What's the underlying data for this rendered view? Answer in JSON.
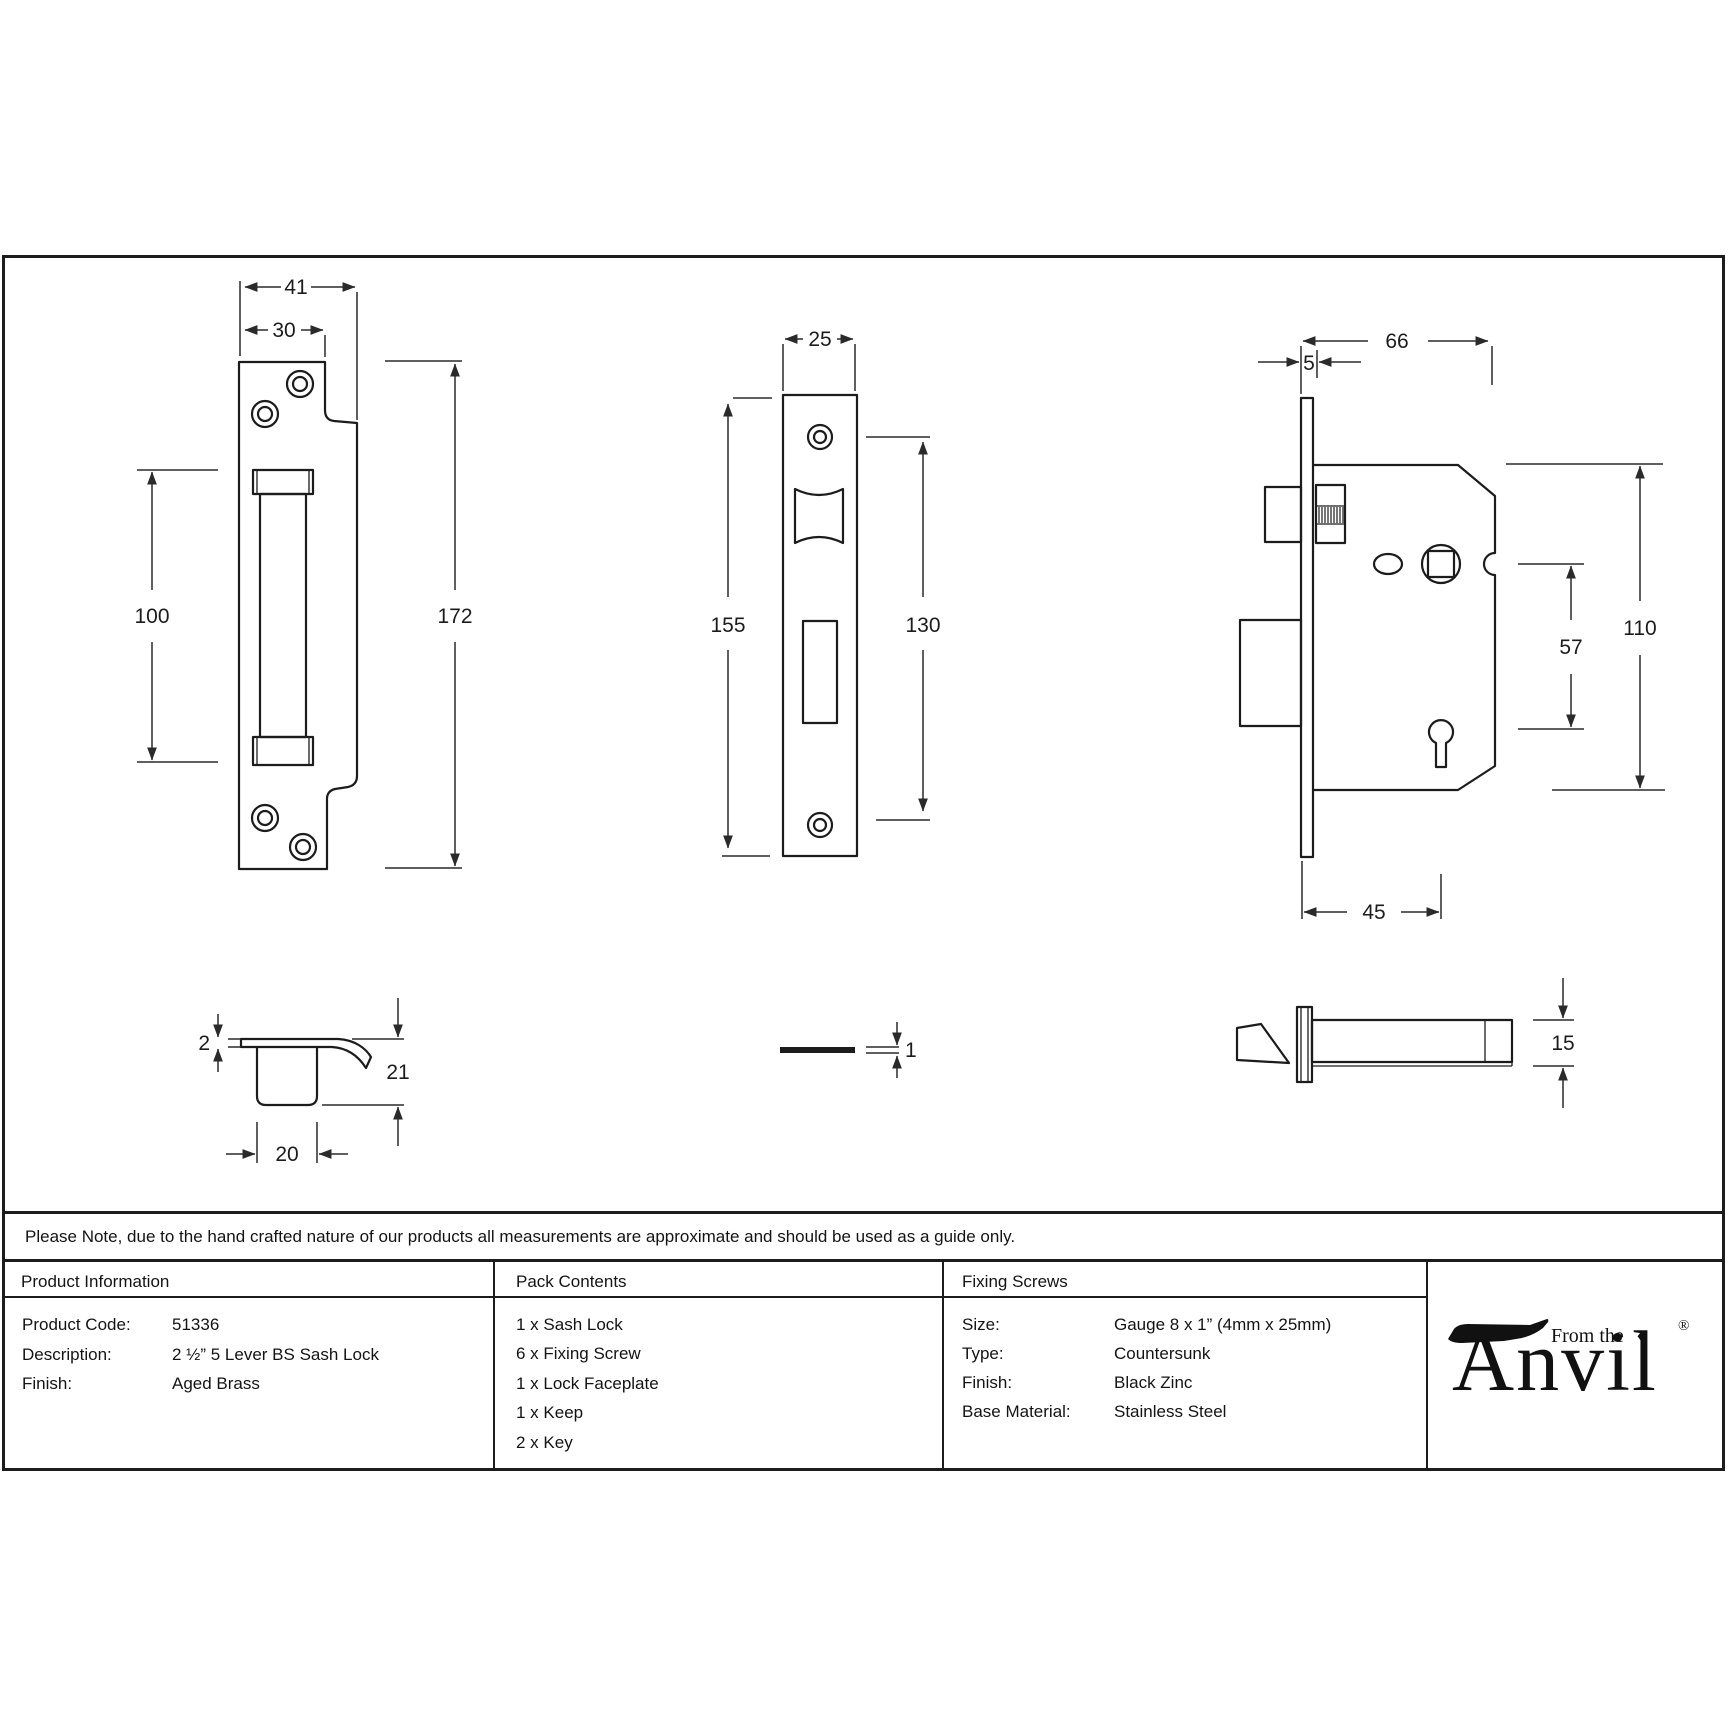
{
  "page": {
    "background": "#ffffff",
    "line_color": "#1c1c1c"
  },
  "note": {
    "text": "Please Note, due to the hand crafted nature of our products all measurements are approximate and should be used as a guide only."
  },
  "table": {
    "product_info": {
      "header": "Product Information",
      "rows": [
        {
          "label": "Product Code:",
          "value": "51336"
        },
        {
          "label": "Description:",
          "value": "2 ½” 5 Lever BS Sash Lock"
        },
        {
          "label": "Finish:",
          "value": "Aged Brass"
        }
      ]
    },
    "pack_contents": {
      "header": "Pack Contents",
      "items": [
        "1 x Sash Lock",
        "6 x Fixing Screw",
        "1 x Lock Faceplate",
        "1 x Keep",
        "2 x Key"
      ]
    },
    "fixing_screws": {
      "header": "Fixing Screws",
      "rows": [
        {
          "label": "Size:",
          "value": "Gauge 8 x 1” (4mm x 25mm)"
        },
        {
          "label": "Type:",
          "value": "Countersunk"
        },
        {
          "label": "Finish:",
          "value": "Black Zinc"
        },
        {
          "label": "Base Material:",
          "value": "Stainless Steel"
        }
      ]
    },
    "logo": {
      "brand": "Anvil",
      "tagline": "From the",
      "diamond": "♦",
      "registered": "®"
    }
  },
  "drawings": {
    "keep_front": {
      "dims": {
        "outer_width": "41",
        "inner_width": "30",
        "slot_height": "100",
        "height": "172"
      }
    },
    "faceplate_front": {
      "dims": {
        "width": "25",
        "height": "155",
        "hole_spacing": "130"
      }
    },
    "lock_body": {
      "dims": {
        "depth": "66",
        "faceplate_thickness": "5",
        "height": "110",
        "spindle_to_keyhole": "57",
        "backset": "45"
      }
    },
    "keep_profile": {
      "dims": {
        "plate_thickness": "2",
        "depth": "21",
        "pocket_width": "20"
      }
    },
    "faceplate_edge": {
      "dims": {
        "thickness": "1"
      }
    },
    "bolt_side": {
      "dims": {
        "height": "15"
      }
    }
  }
}
